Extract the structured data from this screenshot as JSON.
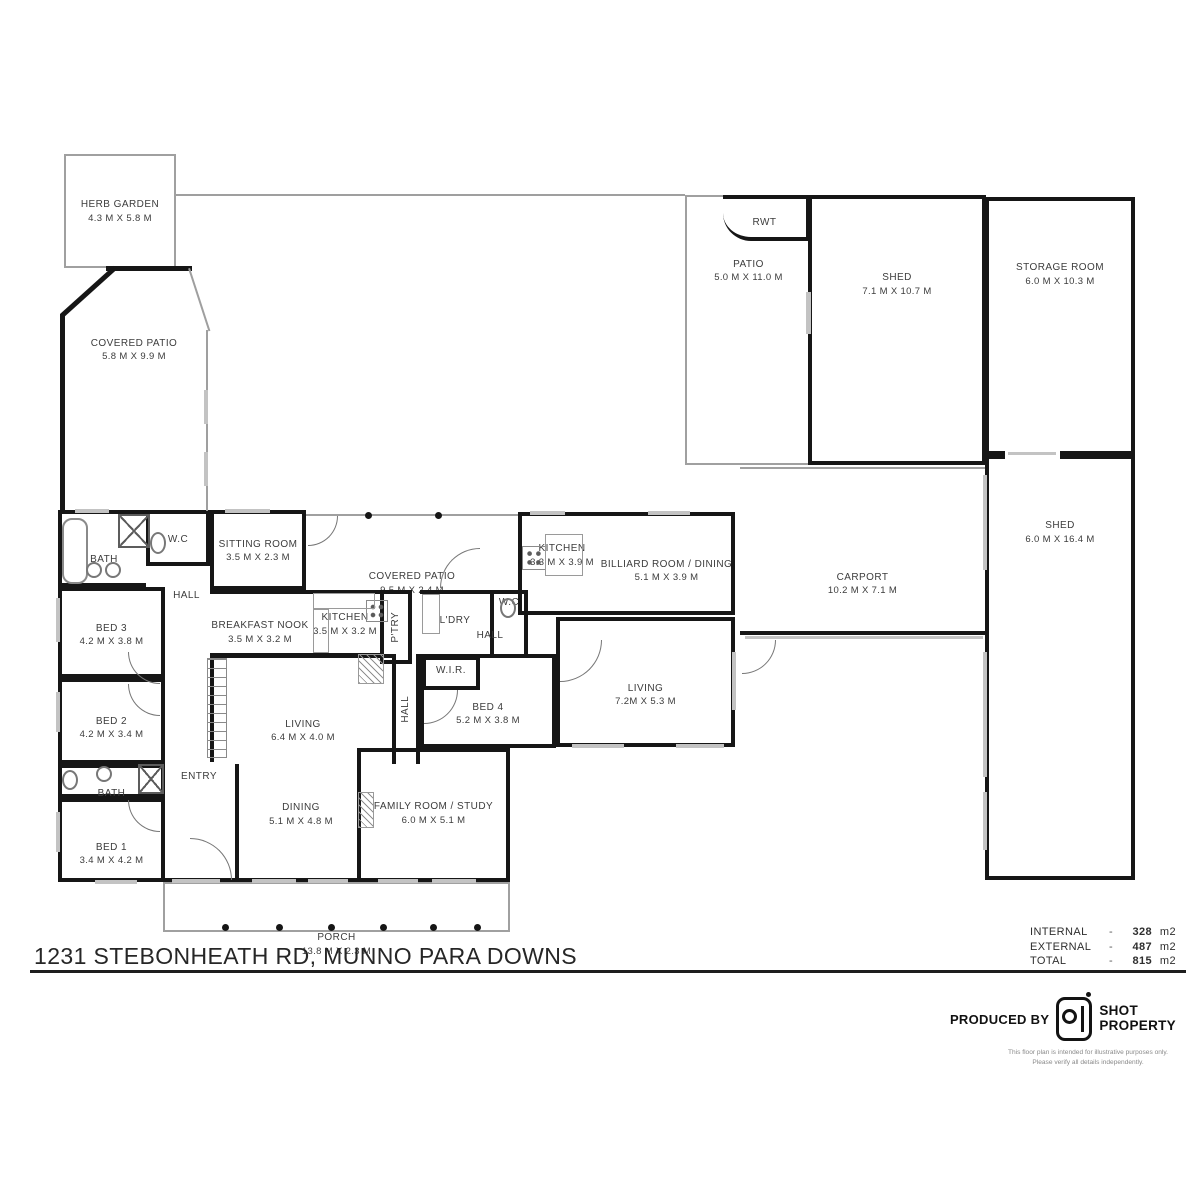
{
  "footer": {
    "title": "1231 STEBONHEATH RD, MUNNO PARA DOWNS",
    "areas": {
      "internal": {
        "label": "INTERNAL",
        "dash": "-",
        "value": "328",
        "unit": "m2"
      },
      "external": {
        "label": "EXTERNAL",
        "dash": "-",
        "value": "487",
        "unit": "m2"
      },
      "total": {
        "label": "TOTAL",
        "dash": "-",
        "value": "815",
        "unit": "m2"
      }
    },
    "produced_by": "PRODUCED BY",
    "brand_line1": "SHOT",
    "brand_line2": "PROPERTY",
    "disclaimer": "This floor plan is intended for illustrative purposes only. Please verify all details independently."
  },
  "plan": {
    "rooms": [
      {
        "id": "herb-garden",
        "n": "HERB GARDEN",
        "d": "4.3 M X 5.8 M",
        "x": 64,
        "y": 154,
        "w": 112,
        "h": 114,
        "b": "tttt",
        "lp": 40
      },
      {
        "id": "covered-patio-rear",
        "n": "COVERED PATIO",
        "d": "5.8 M X 9.9 M",
        "x": 60,
        "y": 268,
        "w": 148,
        "h": 242,
        "b": "nnnn",
        "lp": 47
      },
      {
        "id": "patio",
        "n": "PATIO",
        "d": "5.0 M X 11.0 M",
        "x": 685,
        "y": 195,
        "w": 125,
        "h": 270,
        "b": "tntt",
        "lp": 50
      },
      {
        "id": "rwt",
        "n": "RWT",
        "x": 723,
        "y": 195,
        "w": 87,
        "h": 46,
        "b": "KKKn",
        "lp": 22,
        "cls": "rwt"
      },
      {
        "id": "shed-rear",
        "n": "SHED",
        "d": "7.1 M X 10.7 M",
        "x": 808,
        "y": 195,
        "w": 178,
        "h": 270,
        "b": "KKKK",
        "lp": 43
      },
      {
        "id": "storage-room",
        "n": "STORAGE ROOM",
        "d": "6.0 M X 10.3 M",
        "x": 985,
        "y": 197,
        "w": 150,
        "h": 258,
        "b": "KKKK",
        "lp": 43
      },
      {
        "id": "shed-side",
        "n": "SHED",
        "d": "6.0 M X 16.4 M",
        "x": 985,
        "y": 455,
        "w": 150,
        "h": 425,
        "b": "KKKK",
        "lp": 43
      },
      {
        "id": "carport",
        "n": "CARPORT",
        "d": "10.2 M X 7.1 M",
        "x": 740,
        "y": 467,
        "w": 245,
        "h": 168,
        "b": "tnKn",
        "lp": 42
      },
      {
        "id": "porch",
        "n": "PORCH",
        "d": "13.8 M X 2.3 M",
        "x": 163,
        "y": 882,
        "w": 347,
        "h": 50,
        "b": "tttt",
        "lp": 14
      },
      {
        "id": "bath-main",
        "n": "BATH",
        "x": 58,
        "y": 510,
        "w": 88,
        "h": 77,
        "b": "KnKK",
        "lp": 48
      },
      {
        "id": "wc-main",
        "n": "W.C",
        "x": 146,
        "y": 510,
        "w": 64,
        "h": 56,
        "b": "KKKK",
        "lp": 36
      },
      {
        "id": "sitting-room",
        "n": "SITTING ROOM",
        "d": "3.5 M X 2.3 M",
        "x": 210,
        "y": 510,
        "w": 96,
        "h": 80,
        "b": "KKKK",
        "lp": 28
      },
      {
        "id": "covered-patio-front",
        "n": "COVERED PATIO",
        "d": "9.5 M X 2.4 M",
        "x": 306,
        "y": 514,
        "w": 212,
        "h": 74,
        "b": "tnnn",
        "lp": 26
      },
      {
        "id": "kitchen-rear",
        "n": "KITCHEN",
        "d": "3.3 M X 3.9 M",
        "x": 518,
        "y": 512,
        "w": 84,
        "h": 103,
        "b": "KnKK",
        "lp": 34
      },
      {
        "id": "billiard-room",
        "n": "BILLIARD ROOM / DINING",
        "d": "5.1 M X 3.9 M",
        "x": 602,
        "y": 512,
        "w": 133,
        "h": 103,
        "b": "KKKn",
        "lp": 33
      },
      {
        "id": "hall-west",
        "n": "HALL",
        "x": 163,
        "y": 566,
        "w": 47,
        "h": 90,
        "b": "nnnn",
        "lp": 50
      },
      {
        "id": "breakfast-nook",
        "n": "BREAKFAST NOOK",
        "d": "3.5 M X 3.2 M",
        "x": 210,
        "y": 590,
        "w": 100,
        "h": 67,
        "b": "KnKn",
        "lp": 26
      },
      {
        "id": "kitchen-main",
        "n": "KITCHEN",
        "d": "3.5 M X 3.2 M",
        "x": 310,
        "y": 590,
        "w": 70,
        "h": 67,
        "b": "KnKn",
        "lp": 26
      },
      {
        "id": "pantry",
        "n": "P'TRY",
        "x": 380,
        "y": 590,
        "w": 32,
        "h": 74,
        "b": "KKKK",
        "v": 1
      },
      {
        "id": "laundry",
        "n": "L'DRY",
        "x": 420,
        "y": 590,
        "w": 70,
        "h": 68,
        "b": "KnKn",
        "lp": 30
      },
      {
        "id": "wc-2",
        "n": "W.C",
        "x": 490,
        "y": 590,
        "w": 38,
        "h": 68,
        "b": "KKKK",
        "lp": 10
      },
      {
        "id": "hall-center",
        "n": "HALL",
        "x": 455,
        "y": 624,
        "w": 70,
        "h": 32,
        "b": "nnnn",
        "lp": 8
      },
      {
        "id": "bed-3",
        "n": "BED 3",
        "d": "4.2 M X 3.8 M",
        "x": 58,
        "y": 587,
        "w": 107,
        "h": 91,
        "b": "KKKK",
        "lp": 32
      },
      {
        "id": "living-main",
        "n": "LIVING",
        "d": "6.4 M X 4.0 M",
        "x": 210,
        "y": 654,
        "w": 182,
        "h": 108,
        "b": "KnnK",
        "lp": 34
      },
      {
        "id": "hall-south",
        "n": "HALL",
        "x": 392,
        "y": 654,
        "w": 28,
        "h": 110,
        "b": "nKnK",
        "v": 1
      },
      {
        "id": "bed-4",
        "n": "BED 4",
        "d": "5.2 M X 3.8 M",
        "x": 420,
        "y": 654,
        "w": 136,
        "h": 94,
        "b": "KKKK",
        "lp": 34
      },
      {
        "id": "wir",
        "n": "W.I.R.",
        "x": 422,
        "y": 656,
        "w": 58,
        "h": 34,
        "b": "KKKK",
        "lp": 10
      },
      {
        "id": "living-2",
        "n": "LIVING",
        "d": "7.2M X 5.3 M",
        "x": 556,
        "y": 617,
        "w": 179,
        "h": 130,
        "b": "KKKK",
        "lp": 36
      },
      {
        "id": "bed-2",
        "n": "BED 2",
        "d": "4.2 M X 3.4 M",
        "x": 58,
        "y": 678,
        "w": 107,
        "h": 86,
        "b": "KKKK",
        "lp": 34
      },
      {
        "id": "bath-2",
        "n": "BATH",
        "x": 58,
        "y": 764,
        "w": 107,
        "h": 34,
        "b": "KKKK",
        "lp": 20
      },
      {
        "id": "bed-1",
        "n": "BED 1",
        "d": "3.4 M X 4.2 M",
        "x": 58,
        "y": 798,
        "w": 107,
        "h": 84,
        "b": "KKKK",
        "lp": 40
      },
      {
        "id": "entry",
        "n": "ENTRY",
        "x": 163,
        "y": 748,
        "w": 72,
        "h": 134,
        "b": "nnKn",
        "lp": 32
      },
      {
        "id": "dining",
        "n": "DINING",
        "d": "5.1 M X 4.8 M",
        "x": 235,
        "y": 764,
        "w": 128,
        "h": 118,
        "b": "nnKK",
        "lp": 31
      },
      {
        "id": "family-room",
        "n": "FAMILY ROOM / STUDY",
        "d": "6.0 M X 5.1 M",
        "x": 357,
        "y": 748,
        "w": 153,
        "h": 134,
        "b": "KKKK",
        "lp": 34
      }
    ],
    "decor": [
      {
        "id": "patio-wall-left",
        "t": "wall",
        "x": 60,
        "y": 314,
        "w": 5,
        "h": 197
      },
      {
        "id": "patio-wall-angled",
        "t": "wall",
        "x": 60,
        "y": 314,
        "w": 72,
        "h": 5,
        "r": -42
      },
      {
        "id": "patio-wall-top",
        "t": "wall",
        "x": 106,
        "y": 266,
        "w": 86,
        "h": 5
      },
      {
        "id": "patio-edge-angled",
        "t": "thin",
        "x": 190,
        "y": 268,
        "w": 66,
        "h": 2,
        "r": 72
      },
      {
        "id": "patio-edge-right",
        "t": "thin",
        "x": 206,
        "y": 330,
        "w": 2,
        "h": 181
      },
      {
        "id": "boundary-top",
        "t": "thin",
        "x": 176,
        "y": 194,
        "w": 509,
        "h": 2
      },
      {
        "id": "stairs",
        "t": "stairs",
        "x": 207,
        "y": 658,
        "w": 20,
        "h": 100
      },
      {
        "id": "carport-glass",
        "t": "window",
        "x": 745,
        "y": 636,
        "w": 238,
        "h": 3
      },
      {
        "id": "shed-door-gap",
        "t": "gap",
        "x": 1005,
        "y": 451,
        "w": 55,
        "h": 8
      },
      {
        "id": "shed-door-track",
        "t": "window",
        "x": 1008,
        "y": 452,
        "w": 48,
        "h": 3
      },
      {
        "id": "shed-rear-window",
        "t": "window",
        "x": 806,
        "y": 292,
        "w": 5,
        "h": 42
      },
      {
        "t": "window",
        "x": 56,
        "y": 598,
        "w": 4,
        "h": 44
      },
      {
        "t": "window",
        "x": 56,
        "y": 692,
        "w": 4,
        "h": 40
      },
      {
        "t": "window",
        "x": 56,
        "y": 812,
        "w": 4,
        "h": 40
      },
      {
        "t": "window",
        "x": 95,
        "y": 880,
        "w": 42,
        "h": 4
      },
      {
        "t": "window",
        "x": 172,
        "y": 879,
        "w": 48,
        "h": 4
      },
      {
        "t": "window",
        "x": 252,
        "y": 879,
        "w": 44,
        "h": 4
      },
      {
        "t": "window",
        "x": 308,
        "y": 879,
        "w": 40,
        "h": 4
      },
      {
        "t": "window",
        "x": 378,
        "y": 879,
        "w": 40,
        "h": 4
      },
      {
        "t": "window",
        "x": 432,
        "y": 879,
        "w": 44,
        "h": 4
      },
      {
        "t": "window",
        "x": 572,
        "y": 744,
        "w": 52,
        "h": 4
      },
      {
        "t": "window",
        "x": 676,
        "y": 744,
        "w": 48,
        "h": 4
      },
      {
        "t": "window",
        "x": 732,
        "y": 652,
        "w": 4,
        "h": 58
      },
      {
        "t": "window",
        "x": 648,
        "y": 511,
        "w": 42,
        "h": 4
      },
      {
        "t": "window",
        "x": 530,
        "y": 511,
        "w": 35,
        "h": 4
      },
      {
        "t": "window",
        "x": 225,
        "y": 509,
        "w": 45,
        "h": 4
      },
      {
        "t": "window",
        "x": 75,
        "y": 509,
        "w": 34,
        "h": 4
      },
      {
        "t": "window",
        "x": 983,
        "y": 475,
        "w": 4,
        "h": 95
      },
      {
        "t": "window",
        "x": 983,
        "y": 652,
        "w": 4,
        "h": 125
      },
      {
        "t": "window",
        "x": 983,
        "y": 792,
        "w": 4,
        "h": 58
      },
      {
        "t": "window",
        "x": 204,
        "y": 390,
        "w": 4,
        "h": 34
      },
      {
        "t": "window",
        "x": 204,
        "y": 452,
        "w": 4,
        "h": 34
      },
      {
        "id": "patio-post",
        "t": "dot",
        "x": 365,
        "y": 512,
        "w": 7,
        "h": 7
      },
      {
        "id": "patio-post",
        "t": "dot",
        "x": 435,
        "y": 512,
        "w": 7,
        "h": 7
      },
      {
        "id": "porch-post",
        "t": "dot",
        "x": 222,
        "y": 924,
        "w": 7,
        "h": 7
      },
      {
        "id": "porch-post",
        "t": "dot",
        "x": 276,
        "y": 924,
        "w": 7,
        "h": 7
      },
      {
        "id": "porch-post",
        "t": "dot",
        "x": 328,
        "y": 924,
        "w": 7,
        "h": 7
      },
      {
        "id": "porch-post",
        "t": "dot",
        "x": 380,
        "y": 924,
        "w": 7,
        "h": 7
      },
      {
        "id": "porch-post",
        "t": "dot",
        "x": 430,
        "y": 924,
        "w": 7,
        "h": 7
      },
      {
        "id": "porch-post",
        "t": "dot",
        "x": 474,
        "y": 924,
        "w": 7,
        "h": 7
      },
      {
        "id": "front-door",
        "t": "door-bl",
        "x": 190,
        "y": 838,
        "w": 42,
        "h": 42
      },
      {
        "id": "bed3-door",
        "t": "door-tr",
        "x": 128,
        "y": 652,
        "w": 32,
        "h": 32
      },
      {
        "id": "bed2-door",
        "t": "door-tr",
        "x": 128,
        "y": 684,
        "w": 32,
        "h": 32
      },
      {
        "id": "bed1-door",
        "t": "door-tr",
        "x": 128,
        "y": 800,
        "w": 32,
        "h": 32
      },
      {
        "id": "bed4-door",
        "t": "door-tl",
        "x": 424,
        "y": 690,
        "w": 34,
        "h": 34
      },
      {
        "id": "living2-door",
        "t": "door-tl",
        "x": 560,
        "y": 640,
        "w": 42,
        "h": 42
      },
      {
        "id": "laundry-door",
        "t": "door-br",
        "x": 440,
        "y": 548,
        "w": 40,
        "h": 40
      },
      {
        "id": "sitting-door",
        "t": "door-tl",
        "x": 308,
        "y": 516,
        "w": 30,
        "h": 30
      },
      {
        "id": "carport-door",
        "t": "door-tl",
        "x": 742,
        "y": 640,
        "w": 34,
        "h": 34
      },
      {
        "id": "bathtub",
        "t": "tub",
        "x": 62,
        "y": 518,
        "w": 26,
        "h": 66
      },
      {
        "id": "shower",
        "t": "xbox",
        "x": 118,
        "y": 514,
        "w": 32,
        "h": 34
      },
      {
        "id": "vanity-sink",
        "t": "circle",
        "x": 86,
        "y": 562,
        "w": 16,
        "h": 16
      },
      {
        "id": "vanity-sink",
        "t": "circle",
        "x": 105,
        "y": 562,
        "w": 16,
        "h": 16
      },
      {
        "id": "toilet",
        "t": "ellipse",
        "x": 150,
        "y": 532,
        "w": 16,
        "h": 22
      },
      {
        "id": "toilet",
        "t": "ellipse",
        "x": 500,
        "y": 598,
        "w": 16,
        "h": 20
      },
      {
        "id": "toilet",
        "t": "ellipse",
        "x": 62,
        "y": 770,
        "w": 16,
        "h": 20
      },
      {
        "id": "vanity-sink",
        "t": "circle",
        "x": 96,
        "y": 766,
        "w": 16,
        "h": 16
      },
      {
        "id": "shower",
        "t": "xbox",
        "x": 138,
        "y": 764,
        "w": 26,
        "h": 30
      },
      {
        "id": "cooktop",
        "t": "stove",
        "x": 522,
        "y": 546,
        "w": 24,
        "h": 24
      },
      {
        "id": "cooktop",
        "t": "stove",
        "x": 366,
        "y": 600,
        "w": 22,
        "h": 22
      },
      {
        "id": "bench",
        "t": "rect",
        "x": 313,
        "y": 593,
        "w": 62,
        "h": 16
      },
      {
        "id": "bench",
        "t": "rect",
        "x": 313,
        "y": 609,
        "w": 16,
        "h": 44
      },
      {
        "id": "island-bench",
        "t": "rect",
        "x": 545,
        "y": 534,
        "w": 38,
        "h": 42
      },
      {
        "id": "cabinet",
        "t": "rect",
        "x": 422,
        "y": 594,
        "w": 18,
        "h": 40
      },
      {
        "id": "hatch",
        "t": "hatch",
        "x": 358,
        "y": 654,
        "w": 26,
        "h": 30
      },
      {
        "id": "hatch",
        "t": "hatch",
        "x": 358,
        "y": 792,
        "w": 16,
        "h": 36
      }
    ]
  }
}
